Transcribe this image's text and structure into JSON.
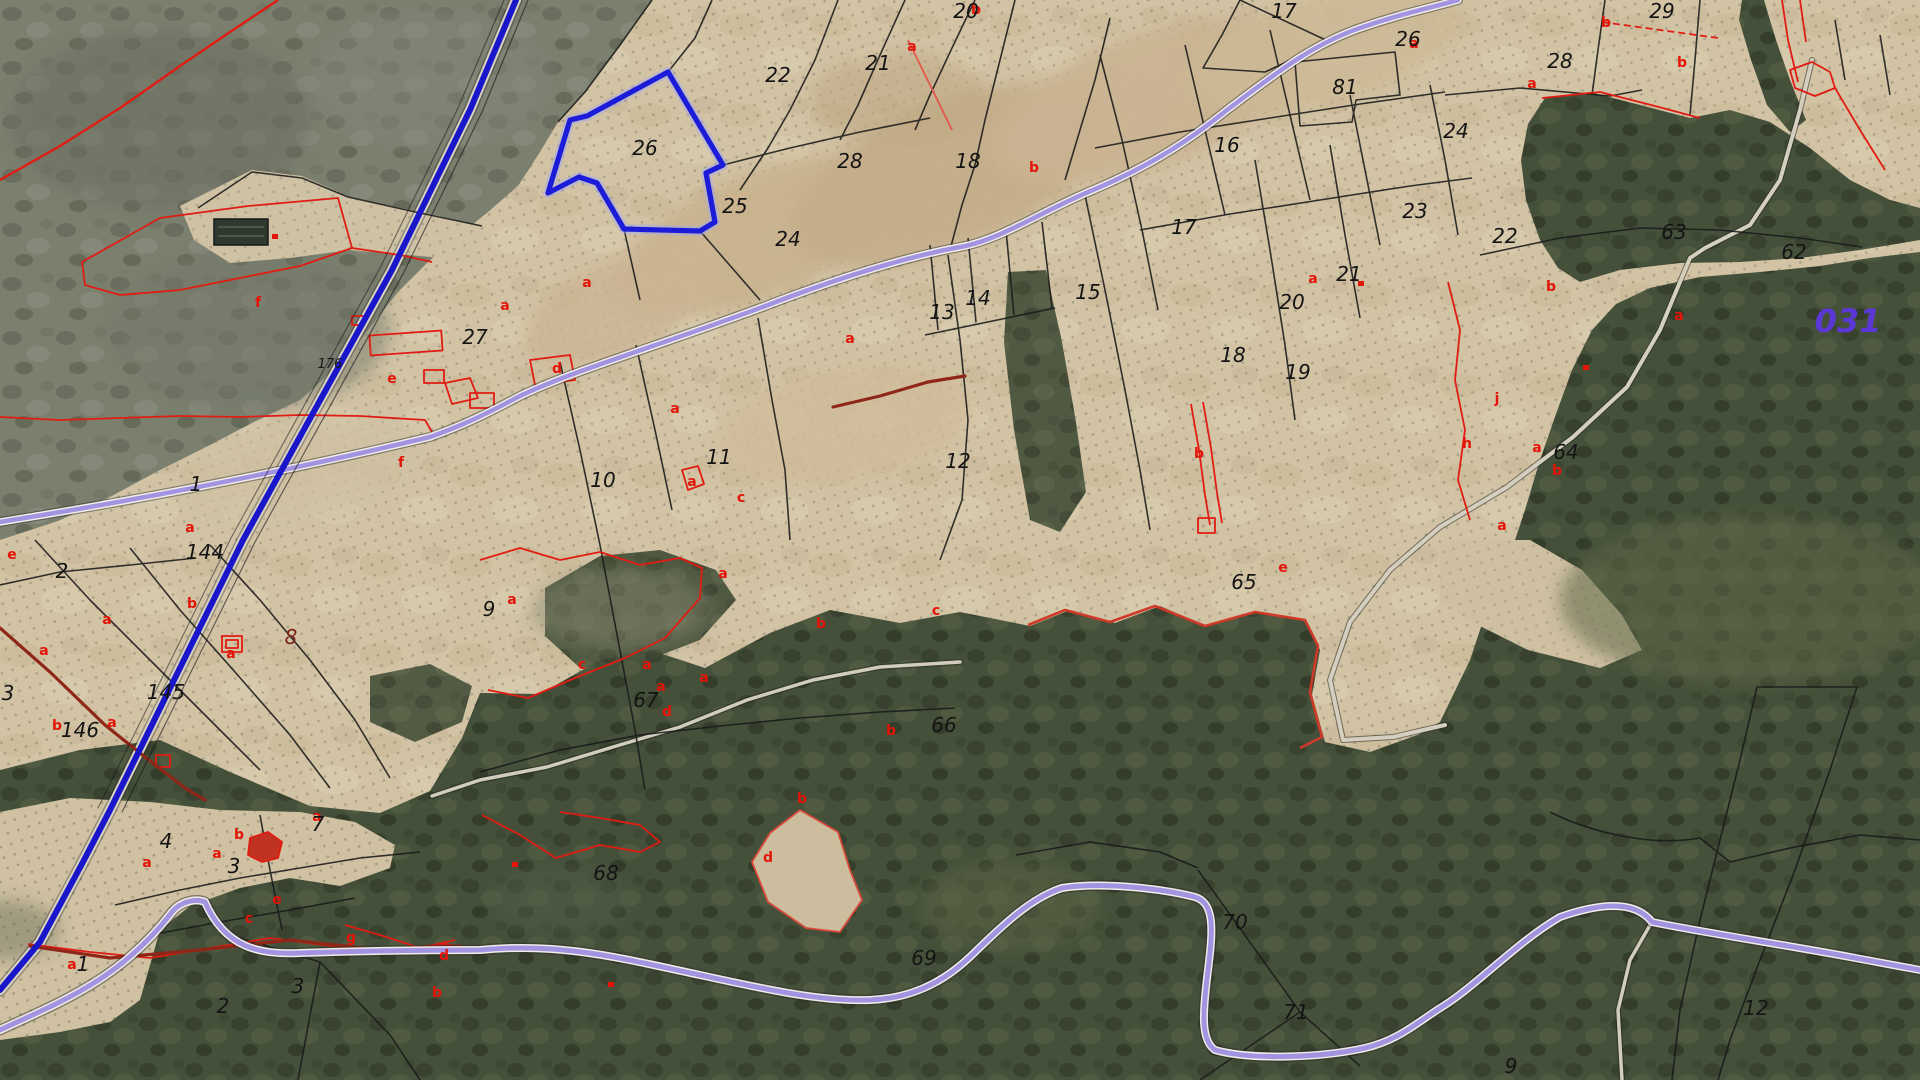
{
  "map": {
    "title": "cadastral-parcel-viewer",
    "zone_label": {
      "text": "031",
      "x": 1848,
      "y": 332,
      "color": "#5b38d6",
      "size": 32
    },
    "selected_parcel": {
      "number": "26",
      "outline_color": "#1c1cd8"
    },
    "colors": {
      "parcel_number": "#141414",
      "subparcel_letter": "#e41408",
      "camino_dark_red": "#8f2718",
      "road_purple": "#a394e2",
      "line_blue": "#1a16c9"
    },
    "parcel_numbers": [
      {
        "t": "20",
        "x": 966,
        "y": 18
      },
      {
        "t": "22",
        "x": 778,
        "y": 82
      },
      {
        "t": "21",
        "x": 878,
        "y": 70
      },
      {
        "t": "26",
        "x": 645,
        "y": 155
      },
      {
        "t": "28",
        "x": 850,
        "y": 168
      },
      {
        "t": "25",
        "x": 735,
        "y": 213
      },
      {
        "t": "24",
        "x": 788,
        "y": 246
      },
      {
        "t": "18",
        "x": 968,
        "y": 168
      },
      {
        "t": "17",
        "x": 1284,
        "y": 18
      },
      {
        "t": "26",
        "x": 1408,
        "y": 46
      },
      {
        "t": "81",
        "x": 1345,
        "y": 94
      },
      {
        "t": "16",
        "x": 1227,
        "y": 152
      },
      {
        "t": "17",
        "x": 1184,
        "y": 234
      },
      {
        "t": "23",
        "x": 1415,
        "y": 218
      },
      {
        "t": "29",
        "x": 1662,
        "y": 18
      },
      {
        "t": "28",
        "x": 1560,
        "y": 68
      },
      {
        "t": "24",
        "x": 1456,
        "y": 138
      },
      {
        "t": "22",
        "x": 1505,
        "y": 243
      },
      {
        "t": "63",
        "x": 1674,
        "y": 239
      },
      {
        "t": "62",
        "x": 1794,
        "y": 259
      },
      {
        "t": "27",
        "x": 475,
        "y": 344
      },
      {
        "t": "176",
        "x": 330,
        "y": 368,
        "s": 13
      },
      {
        "t": "13",
        "x": 942,
        "y": 319
      },
      {
        "t": "14",
        "x": 978,
        "y": 305
      },
      {
        "t": "15",
        "x": 1088,
        "y": 299
      },
      {
        "t": "20",
        "x": 1292,
        "y": 309
      },
      {
        "t": "18",
        "x": 1233,
        "y": 362
      },
      {
        "t": "19",
        "x": 1298,
        "y": 379
      },
      {
        "t": "21",
        "x": 1349,
        "y": 281
      },
      {
        "t": "11",
        "x": 719,
        "y": 464
      },
      {
        "t": "10",
        "x": 603,
        "y": 487
      },
      {
        "t": "12",
        "x": 958,
        "y": 468
      },
      {
        "t": "64",
        "x": 1566,
        "y": 459
      },
      {
        "t": "1",
        "x": 196,
        "y": 491
      },
      {
        "t": "144",
        "x": 205,
        "y": 559
      },
      {
        "t": "2",
        "x": 62,
        "y": 578
      },
      {
        "t": "3",
        "x": 8,
        "y": 700
      },
      {
        "t": "145",
        "x": 166,
        "y": 699
      },
      {
        "t": "146",
        "x": 80,
        "y": 737
      },
      {
        "t": "8",
        "x": 291,
        "y": 644,
        "c": "#7b2418"
      },
      {
        "t": "9",
        "x": 489,
        "y": 616
      },
      {
        "t": "67",
        "x": 646,
        "y": 707
      },
      {
        "t": "66",
        "x": 944,
        "y": 732
      },
      {
        "t": "65",
        "x": 1244,
        "y": 589
      },
      {
        "t": "68",
        "x": 606,
        "y": 880
      },
      {
        "t": "69",
        "x": 924,
        "y": 965
      },
      {
        "t": "70",
        "x": 1235,
        "y": 929
      },
      {
        "t": "71",
        "x": 1296,
        "y": 1019
      },
      {
        "t": "12",
        "x": 1756,
        "y": 1015
      },
      {
        "t": "9",
        "x": 1511,
        "y": 1073
      },
      {
        "t": "4",
        "x": 166,
        "y": 848
      },
      {
        "t": "3",
        "x": 234,
        "y": 873
      },
      {
        "t": "7",
        "x": 318,
        "y": 831
      },
      {
        "t": "1",
        "x": 83,
        "y": 971
      },
      {
        "t": "2",
        "x": 223,
        "y": 1013
      },
      {
        "t": "3",
        "x": 298,
        "y": 993
      }
    ],
    "subparcel_letters": [
      {
        "t": "b",
        "x": 976,
        "y": 14
      },
      {
        "t": "a",
        "x": 912,
        "y": 51
      },
      {
        "t": "a",
        "x": 1414,
        "y": 48
      },
      {
        "t": "b",
        "x": 1034,
        "y": 172
      },
      {
        "t": "a",
        "x": 1532,
        "y": 88
      },
      {
        "t": "b",
        "x": 1682,
        "y": 67
      },
      {
        "t": "b",
        "x": 1606,
        "y": 27
      },
      {
        "t": "f",
        "x": 258,
        "y": 307
      },
      {
        "t": "a",
        "x": 505,
        "y": 310
      },
      {
        "t": "e",
        "x": 392,
        "y": 383
      },
      {
        "t": "f",
        "x": 401,
        "y": 467
      },
      {
        "t": "a",
        "x": 190,
        "y": 532
      },
      {
        "t": "a",
        "x": 587,
        "y": 287
      },
      {
        "t": "d",
        "x": 557,
        "y": 373
      },
      {
        "t": "a",
        "x": 675,
        "y": 413
      },
      {
        "t": "a",
        "x": 692,
        "y": 486
      },
      {
        "t": "c",
        "x": 741,
        "y": 502
      },
      {
        "t": "a",
        "x": 850,
        "y": 343
      },
      {
        "t": "b",
        "x": 1199,
        "y": 458
      },
      {
        "t": "a",
        "x": 1313,
        "y": 283
      },
      {
        "t": "b",
        "x": 1551,
        "y": 291
      },
      {
        "t": "j",
        "x": 1497,
        "y": 403
      },
      {
        "t": "h",
        "x": 1467,
        "y": 448
      },
      {
        "t": "a",
        "x": 1537,
        "y": 452
      },
      {
        "t": "b",
        "x": 1557,
        "y": 475
      },
      {
        "t": "a",
        "x": 1502,
        "y": 530
      },
      {
        "t": "e",
        "x": 1283,
        "y": 572
      },
      {
        "t": "e",
        "x": 12,
        "y": 559
      },
      {
        "t": "a",
        "x": 107,
        "y": 624
      },
      {
        "t": "b",
        "x": 57,
        "y": 730
      },
      {
        "t": "a",
        "x": 112,
        "y": 727
      },
      {
        "t": "b",
        "x": 192,
        "y": 608
      },
      {
        "t": "a",
        "x": 44,
        "y": 655
      },
      {
        "t": "a",
        "x": 231,
        "y": 658
      },
      {
        "t": "a",
        "x": 147,
        "y": 867
      },
      {
        "t": "a",
        "x": 217,
        "y": 858
      },
      {
        "t": "b",
        "x": 239,
        "y": 839
      },
      {
        "t": "a",
        "x": 317,
        "y": 821
      },
      {
        "t": "a",
        "x": 72,
        "y": 969
      },
      {
        "t": "c",
        "x": 249,
        "y": 923
      },
      {
        "t": "e",
        "x": 277,
        "y": 904
      },
      {
        "t": "g",
        "x": 351,
        "y": 942
      },
      {
        "t": "d",
        "x": 444,
        "y": 960
      },
      {
        "t": "b",
        "x": 437,
        "y": 997
      },
      {
        "t": "a",
        "x": 512,
        "y": 604
      },
      {
        "t": "c",
        "x": 582,
        "y": 669
      },
      {
        "t": "a",
        "x": 647,
        "y": 669
      },
      {
        "t": "a",
        "x": 704,
        "y": 682
      },
      {
        "t": "a",
        "x": 661,
        "y": 691
      },
      {
        "t": "d",
        "x": 667,
        "y": 716
      },
      {
        "t": "a",
        "x": 723,
        "y": 578
      },
      {
        "t": "b",
        "x": 821,
        "y": 628
      },
      {
        "t": "c",
        "x": 936,
        "y": 615
      },
      {
        "t": "b",
        "x": 891,
        "y": 735
      },
      {
        "t": "b",
        "x": 802,
        "y": 803
      },
      {
        "t": "d",
        "x": 768,
        "y": 862
      },
      {
        "t": "a",
        "x": 1679,
        "y": 320
      }
    ],
    "red_markers": [
      {
        "x": 1358,
        "y": 281
      },
      {
        "x": 1583,
        "y": 365
      },
      {
        "x": 272,
        "y": 234
      },
      {
        "x": 608,
        "y": 982
      },
      {
        "x": 512,
        "y": 862
      }
    ]
  }
}
